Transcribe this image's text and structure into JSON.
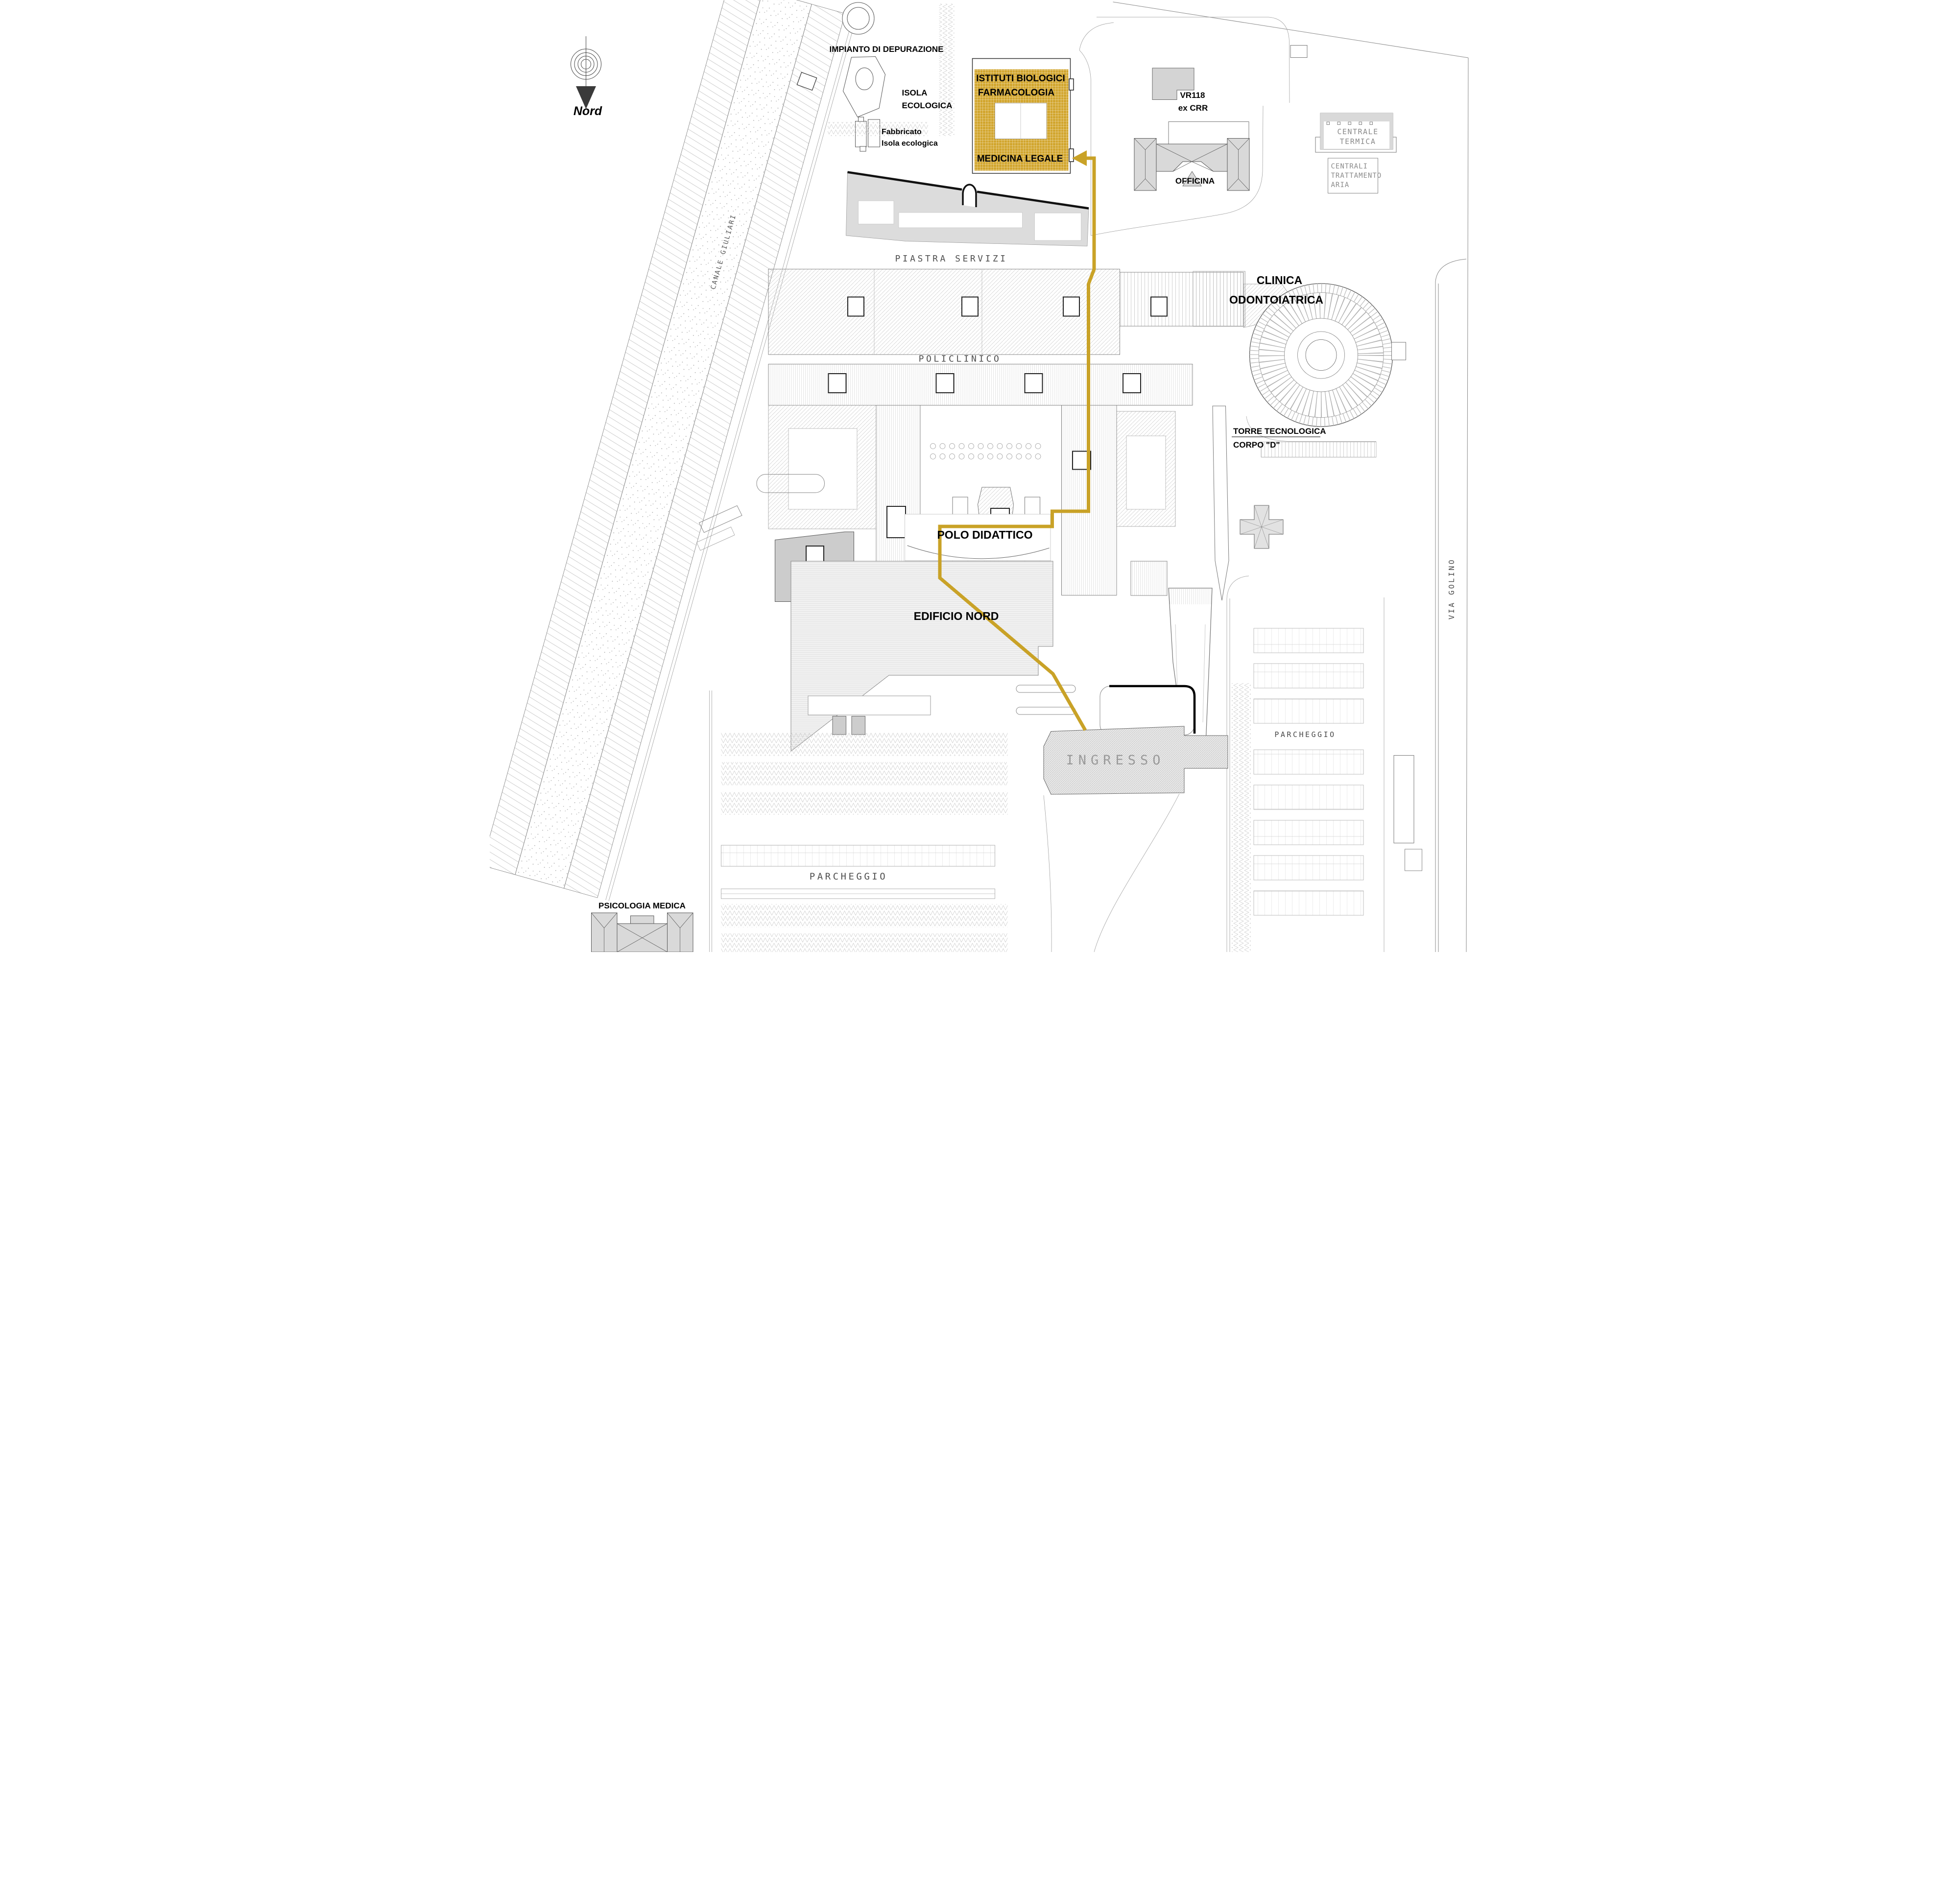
{
  "colors": {
    "highlight_fill": "#D2A62E",
    "route": "#C9A227",
    "building_gray": "#D9D9D9",
    "hatch_gray": "#BDBDBD"
  },
  "compass": {
    "label": "Nord"
  },
  "labels": {
    "impianto": "IMPIANTO DI DEPURAZIONE",
    "isola_line1": "ISOLA",
    "isola_line2": "ECOLOGICA",
    "fabbricato_line1": "Fabbricato",
    "fabbricato_line2": "Isola ecologica",
    "istituti_line1": "ISTITUTI BIOLOGICI",
    "istituti_line2": "FARMACOLOGIA",
    "medicina": "MEDICINA LEGALE",
    "vr118_line1": "VR118",
    "vr118_line2": "ex CRR",
    "officina": "OFFICINA",
    "centrale_line1": "CENTRALE",
    "centrale_line2": "TERMICA",
    "centrali_line1": "CENTRALI",
    "centrali_line2": "TRATTAMENTO",
    "centrali_line3": "ARIA",
    "canale": "CANALE GIULIARI",
    "piastra": "PIASTRA SERVIZI",
    "policlinico": "POLICLINICO",
    "clinica_line1": "CLINICA",
    "clinica_line2": "ODONTOIATRICA",
    "torre_line1": "TORRE TECNOLOGICA",
    "torre_line2": "CORPO \"D\"",
    "polo": "POLO DIDATTICO",
    "edificio": "EDIFICIO NORD",
    "ingresso": "INGRESSO",
    "parcheggio_sud": "PARCHEGGIO",
    "parcheggio_est": "PARCHEGGIO",
    "via_golino": "VIA GOLINO",
    "psicologia": "PSICOLOGIA MEDICA"
  }
}
